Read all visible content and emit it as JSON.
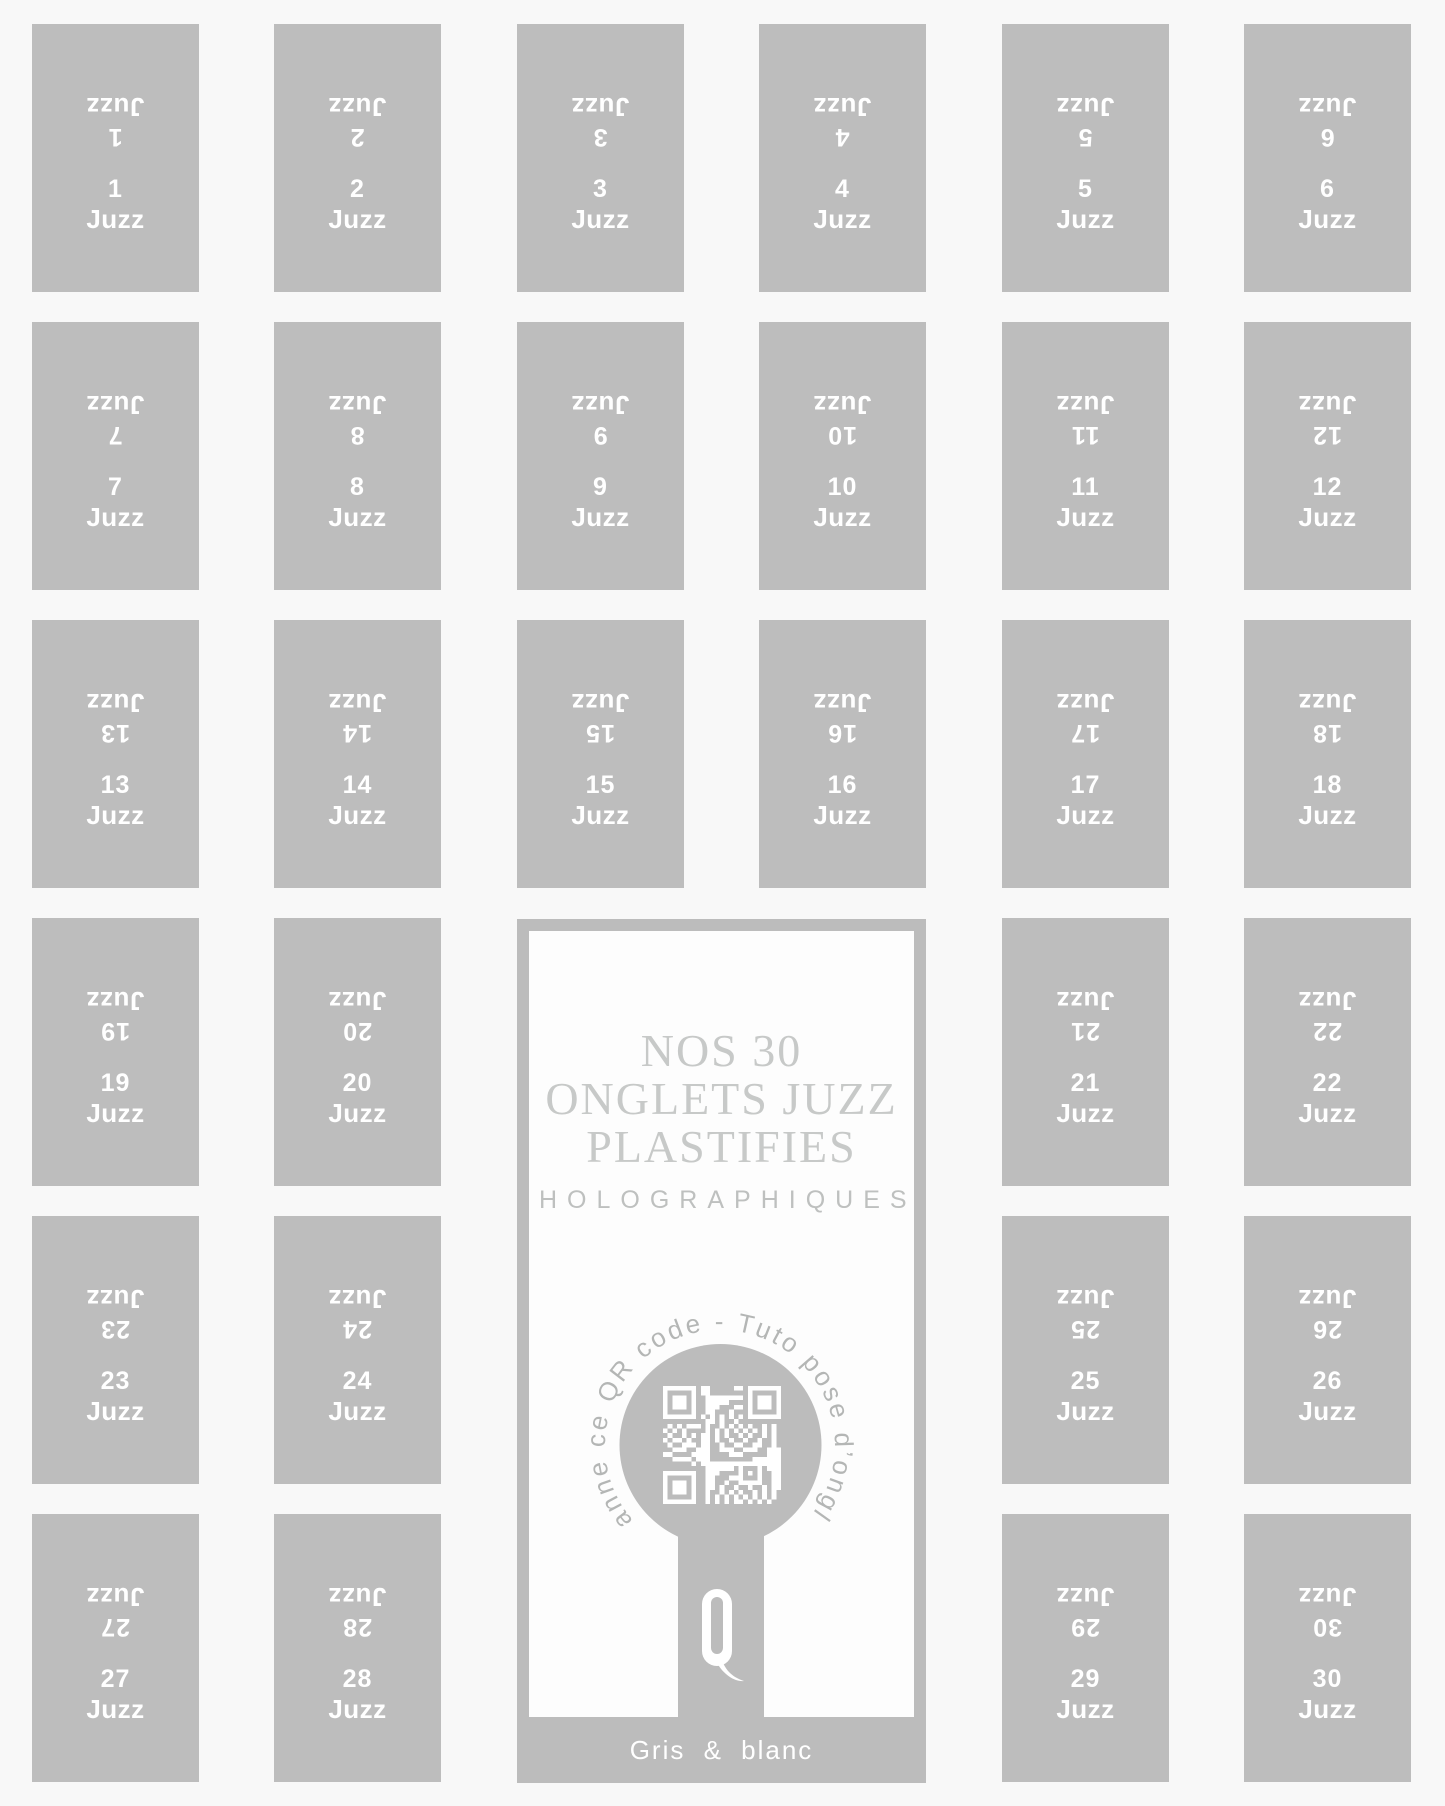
{
  "sheet": {
    "tab_word": "Juzz",
    "tab_numbers": [
      "1",
      "2",
      "3",
      "4",
      "5",
      "6",
      "7",
      "8",
      "9",
      "10",
      "11",
      "12",
      "13",
      "14",
      "15",
      "16",
      "17",
      "18",
      "19",
      "20",
      "21",
      "22",
      "23",
      "24",
      "25",
      "26",
      "27",
      "28",
      "29",
      "30"
    ]
  },
  "panel": {
    "title_lines": [
      "NOS 30",
      "ONGLETS JUZZ",
      "PLASTIFIES"
    ],
    "subtitle": "HOLOGRAPHIQUES",
    "arc_text": "Scanne ce QR code - Tuto pose d’onglets",
    "logo_letter": "Q",
    "footer": "Gris & blanc"
  },
  "colors": {
    "background": "#f8f8f8",
    "tab_gray": "#bdbdbd",
    "panel_gray": "#bcbcbc",
    "panel_background": "#fdfdfd",
    "title_gray": "#c7c9c8",
    "subtitle_gray": "#bec0bf",
    "arc_text_gray": "#b4b6b5",
    "text_white": "#ffffff"
  }
}
